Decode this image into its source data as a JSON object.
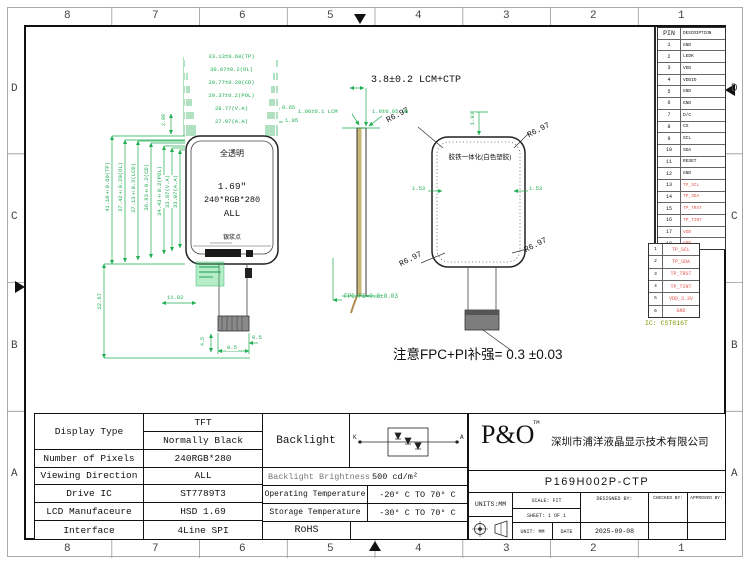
{
  "sheet": {
    "zone_cols": [
      "8",
      "7",
      "6",
      "5",
      "4",
      "3",
      "2",
      "1"
    ],
    "zone_rows": [
      "D",
      "C",
      "B",
      "A"
    ]
  },
  "front_view": {
    "glass_label": "全透明",
    "size": "1.69″",
    "resolution": "240*RGB*280",
    "viewing": "ALL",
    "silver_dot": "银浆点",
    "dims_top": [
      "33.13±0.60(TP)",
      "30.07±0.2(OL)",
      "29.77±0.20(CD)",
      "29.37±0.2(POL)",
      "28.77(V.A)",
      "27.97(A.A)"
    ],
    "dim_right_1": "0.65",
    "dim_right_2": "1.05",
    "dims_left": [
      "41.10±0.60(TP)",
      "37.42±0.20(OL)",
      "37.13±0.2(LCD)",
      "36.83±0.2(CD)",
      "34.43±0.2(POL)",
      "33.87(V.A)",
      "33.07(A.A)"
    ],
    "dim_fpc_len": "22.67",
    "dim_top_bezel": "2.98",
    "dim_stiffener": "11.82",
    "dim_conn_w": "8.5",
    "dim_conn_side": "0.5",
    "dim_conn_h": "4.5"
  },
  "side_view": {
    "dim_total": "3.8±0.2 LCM+CTP",
    "dim_lcm": "1.06±0.1 LCM",
    "dim_ob": "1.9±0.05 OB",
    "dim_fpc": "FPC+PI=0.3±0.03"
  },
  "back_view": {
    "center_label": "胶铁一体化(白色塑胶)",
    "r_tl": "R6.97",
    "r_tr": "R6.97",
    "r_bl": "R6.97",
    "r_br": "R6.97",
    "dim_top": "1.93",
    "dim_left": "1.53",
    "dim_right": "1.53"
  },
  "note": "注意FPC+PI补强= 0.3 ±0.03",
  "pin_table": {
    "h_pin": "PIN",
    "h_desc": "DESCRIPTION",
    "rows": [
      {
        "pin": "1",
        "desc": "GND"
      },
      {
        "pin": "2",
        "desc": "LEDK"
      },
      {
        "pin": "3",
        "desc": "VDD"
      },
      {
        "pin": "4",
        "desc": "VDDIO"
      },
      {
        "pin": "5",
        "desc": "GND"
      },
      {
        "pin": "6",
        "desc": "GND"
      },
      {
        "pin": "7",
        "desc": "D/C"
      },
      {
        "pin": "8",
        "desc": "CS"
      },
      {
        "pin": "9",
        "desc": "SCL"
      },
      {
        "pin": "10",
        "desc": "SDA"
      },
      {
        "pin": "11",
        "desc": "RESET"
      },
      {
        "pin": "12",
        "desc": "GND"
      },
      {
        "pin": "13",
        "desc": "TP_SCL"
      },
      {
        "pin": "14",
        "desc": "TP_SDA"
      },
      {
        "pin": "15",
        "desc": "TP_TRST"
      },
      {
        "pin": "16",
        "desc": "TP_TINT"
      },
      {
        "pin": "17",
        "desc": "VDD"
      },
      {
        "pin": "18",
        "desc": "GND"
      }
    ]
  },
  "tp_table": {
    "rows": [
      {
        "n": "1",
        "label": "TP_SCL"
      },
      {
        "n": "2",
        "label": "TP_SDA"
      },
      {
        "n": "3",
        "label": "TP_TRST"
      },
      {
        "n": "4",
        "label": "TP_TINT"
      },
      {
        "n": "5",
        "label": "VDD_3.3V"
      },
      {
        "n": "6",
        "label": "GND"
      }
    ],
    "ic": "IC: CST816T"
  },
  "spec_table": {
    "display_type_l": "Display Type",
    "display_type_v1": "TFT",
    "display_type_v2": "Normally Black",
    "pixels_l": "Number of Pixels",
    "pixels_v": "240RGB*280",
    "viewing_l": "Viewing Direction",
    "viewing_v": "ALL",
    "drive_ic_l": "Drive IC",
    "drive_ic_v": "ST7789T3",
    "mfr_l": "LCD Manufaceure",
    "mfr_v": "HSD 1.69",
    "iface_l": "Interface",
    "iface_v": "4Line SPI"
  },
  "env_table": {
    "backlight_l": "Backlight",
    "k": "K",
    "a": "A",
    "brightness_l": "Backlight Brightness",
    "brightness_v": "500 cd/m²",
    "op_l": "Operating Temperature",
    "op_v": "-20° C TO 70° C",
    "st_l": "Storage Temperature",
    "st_v": "-30° C TO 70° C",
    "rohs": "RoHS"
  },
  "title_block": {
    "logo": "P&O",
    "tm": "TM",
    "company": "深圳市浦洋液晶显示技术有限公司",
    "part_number": "P169H002P-CTP",
    "units": "UNITS:MM",
    "scale": "SCALE: FIT",
    "designed": "DESIGNED BY:",
    "checked": "CHECKED BY:",
    "approved": "APPROVED BY:",
    "sheet_no": "SHEET: 1 OF 1",
    "unit": "UNIT: MM",
    "date_label": "DATE",
    "date": "2025-09-08"
  }
}
